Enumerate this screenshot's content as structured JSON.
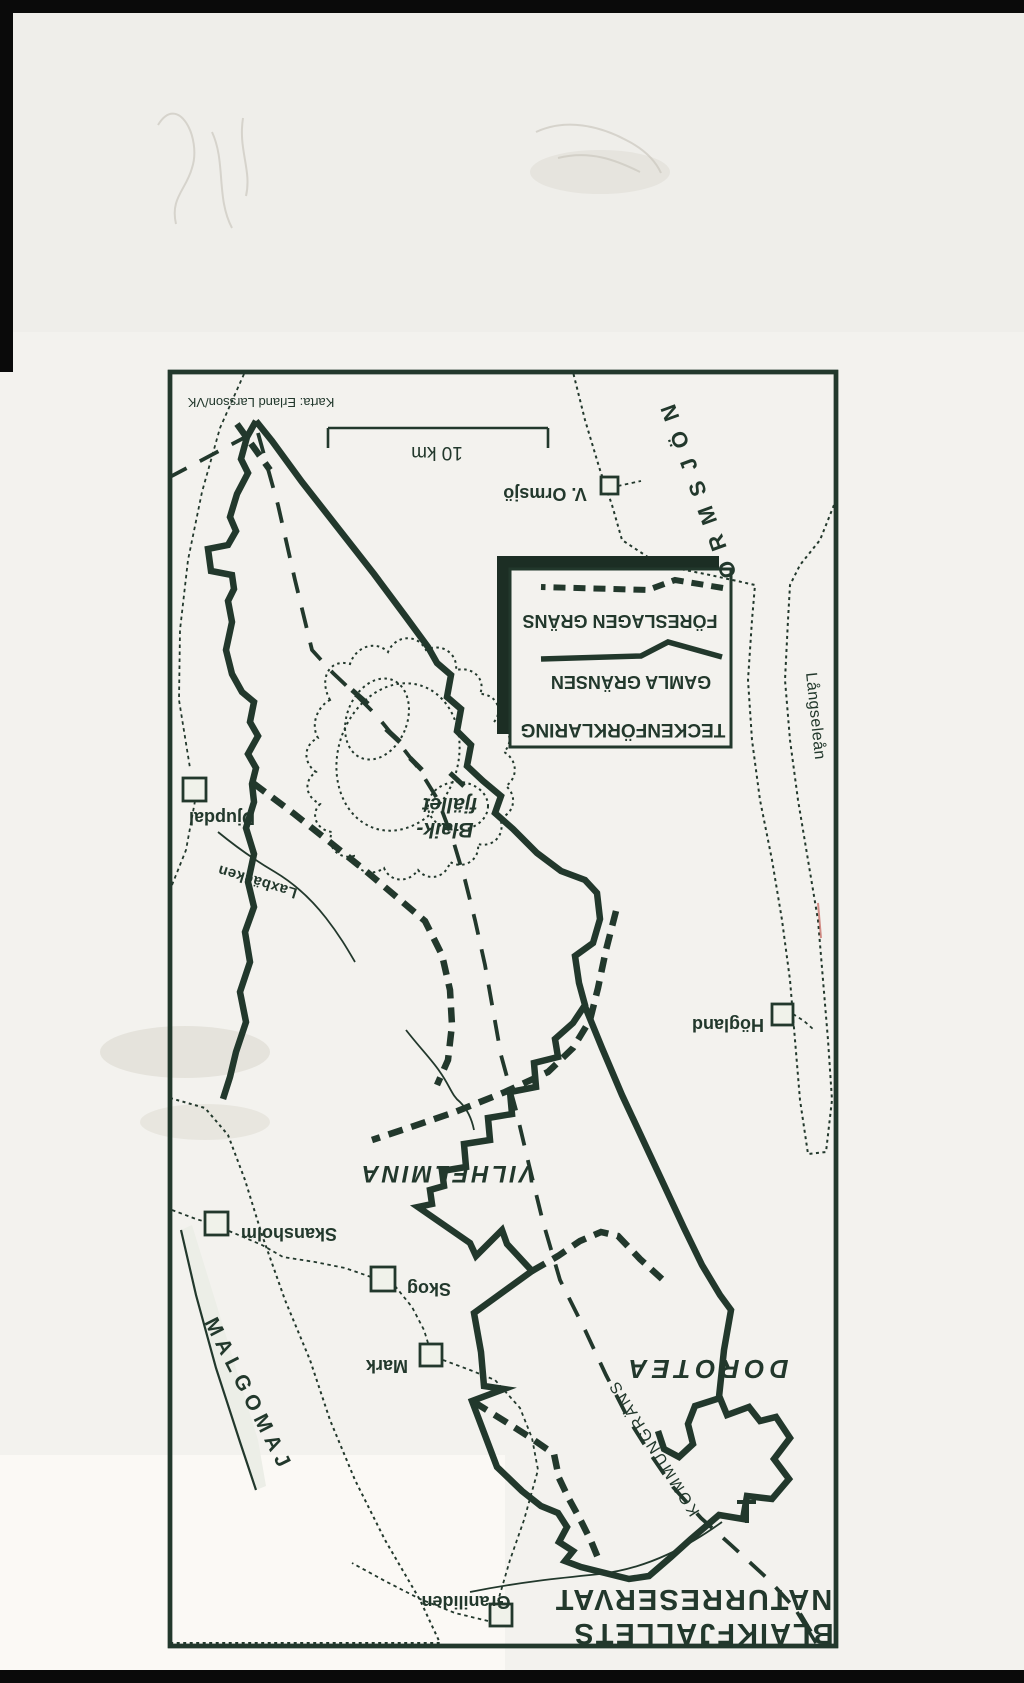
{
  "photo": {
    "credit": "Karta: Erland Larsson/VK"
  },
  "map": {
    "scale_label": "10 km",
    "legend": {
      "title": "TECKENFÖRKLARING",
      "items": [
        {
          "label": "FÖRESLAGEN GRÄNS",
          "style": "dashed"
        },
        {
          "label": "GAMLA GRÄNSEN",
          "style": "solid"
        }
      ]
    },
    "title": {
      "line1": "BLAIKFJÄLLETS",
      "line2": "NATURRESERVAT"
    },
    "places": [
      {
        "name": "V. Ormsjö"
      },
      {
        "name": "Djupdal"
      },
      {
        "name": "Högland"
      },
      {
        "name": "Skansholm"
      },
      {
        "name": "Skog"
      },
      {
        "name": "Mark"
      },
      {
        "name": "Graniliden"
      }
    ],
    "regions": [
      {
        "name": "VILHELMINA"
      },
      {
        "name": "DOROTEA"
      }
    ],
    "waters": [
      {
        "name": "ORMSJÖN"
      },
      {
        "name": "Långseleån"
      },
      {
        "name": "MALGOMAJ"
      },
      {
        "name": "Laxbäcken"
      }
    ],
    "mountain": {
      "line1": "fjället",
      "line2": "Blaik-"
    },
    "kommun_label": "KOMMUNGRÄNS"
  },
  "colors": {
    "ink": "#22382c",
    "paper": "#f3f2ed",
    "map_bg": "#edefe8",
    "water_fill": "#dce2d6",
    "water_dot": "#4e614f",
    "photo_edge": "#0a0a0a",
    "red_mark": "#c0564f"
  }
}
